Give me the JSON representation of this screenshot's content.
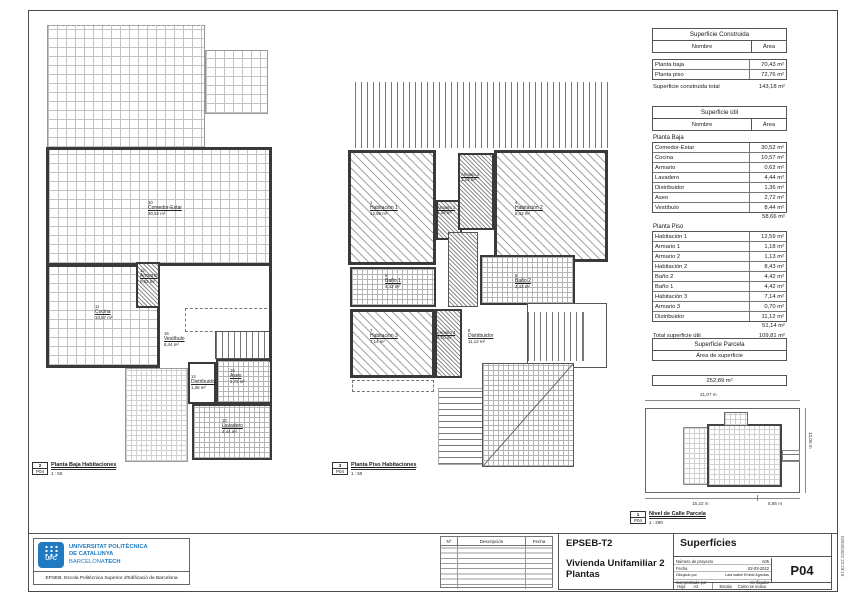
{
  "colors": {
    "brand_blue": "#1f7ac2",
    "wall_gray": "#3a3a3a"
  },
  "sheet": {
    "timestamp_vertical": "02/03/2022 22:29:19"
  },
  "surface_built": {
    "title": "Superficie Construida",
    "col_name": "Nombre",
    "col_area": "Área",
    "rows": [
      {
        "name": "Planta baja",
        "area": "70,43 m²"
      },
      {
        "name": "Planta piso",
        "area": "72,76 m²"
      }
    ],
    "total_label": "Superficie construida total",
    "total_value": "143,18 m²"
  },
  "surface_util": {
    "title": "Superficie útil",
    "col_name": "Nombre",
    "col_area": "Área",
    "baja_label": "Planta Baja",
    "baja_rows": [
      {
        "name": "Comedor-Estar",
        "area": "30,52 m²"
      },
      {
        "name": "Cocina",
        "area": "10,57 m²"
      },
      {
        "name": "Armario",
        "area": "0,62 m²"
      },
      {
        "name": "Lavadero",
        "area": "4,44 m²"
      },
      {
        "name": "Distribuidor",
        "area": "1,36 m²"
      },
      {
        "name": "Aseo",
        "area": "2,72 m²"
      },
      {
        "name": "Vestíbulo",
        "area": "8,44 m²"
      }
    ],
    "baja_subtotal": "58,66 m²",
    "piso_label": "Planta Piso",
    "piso_rows": [
      {
        "name": "Habitación 1",
        "area": "12,59 m²"
      },
      {
        "name": "Armario 1",
        "area": "1,18 m²"
      },
      {
        "name": "Armario 2",
        "area": "1,13 m²"
      },
      {
        "name": "Habitación 2",
        "area": "8,43 m²"
      },
      {
        "name": "Baño 2",
        "area": "4,42 m²"
      },
      {
        "name": "Baño 1",
        "area": "4,42 m²"
      },
      {
        "name": "Habitación 3",
        "area": "7,14 m²"
      },
      {
        "name": "Armario 3",
        "area": "0,70 m²"
      },
      {
        "name": "Distribuidor",
        "area": "11,12 m²"
      }
    ],
    "piso_subtotal": "51,14 m²",
    "total_label": "Total superficie útil",
    "total_value": "109,81 m²"
  },
  "surface_parcel": {
    "title": "Superficie Parcela",
    "subtitle": "Área de superficie",
    "value": "252,89 m²"
  },
  "plan_baja": {
    "rooms": [
      {
        "num": "10",
        "name": "Comedor-Estar",
        "area": "30,52 m²"
      },
      {
        "num": "11",
        "name": "Cocina",
        "area": "10,57 m²"
      },
      {
        "num": "12",
        "name": "Armario",
        "area": "0,62 m²"
      },
      {
        "num": "16",
        "name": "Vestíbulo",
        "area": "8,44 m²"
      },
      {
        "num": "14",
        "name": "Distribuidor",
        "area": "1,36 m²"
      },
      {
        "num": "15",
        "name": "Aseo",
        "area": "2,72 m²"
      },
      {
        "num": "13",
        "name": "Lavadero",
        "area": "4,44 m²"
      }
    ],
    "caption": {
      "num": "2",
      "title": "Planta Baja Habitaciones",
      "sheet": "P04",
      "scale": "1 : 50"
    }
  },
  "plan_piso": {
    "rooms": [
      {
        "num": "1",
        "name": "Habitación 1",
        "area": "12,59 m²"
      },
      {
        "num": "2",
        "name": "Armario 1",
        "area": "1,18 m²"
      },
      {
        "num": "3",
        "name": "Armario 2",
        "area": "1,13 m²"
      },
      {
        "num": "4",
        "name": "Habitación 2",
        "area": "8,43 m²"
      },
      {
        "num": "6",
        "name": "Baño 1",
        "area": "4,42 m²"
      },
      {
        "num": "5",
        "name": "Baño 2",
        "area": "4,42 m²"
      },
      {
        "num": "7",
        "name": "Habitación 3",
        "area": "7,14 m²"
      },
      {
        "num": "9",
        "name": "Armario 3",
        "area": "0,70 m²"
      },
      {
        "num": "8",
        "name": "Distribuidor",
        "area": "11,12 m²"
      }
    ],
    "caption": {
      "num": "3",
      "title": "Planta Piso Habitaciones",
      "sheet": "P04",
      "scale": "1 : 50"
    }
  },
  "site_plan": {
    "dims": {
      "top": "21,07 m",
      "right": "12,00 m",
      "bottom_left": "15,22 m",
      "bottom_right": "5,85 m"
    },
    "caption": {
      "num": "1",
      "title": "Nivel de Calle Parcela",
      "sheet": "P04",
      "scale": "1 : 200"
    }
  },
  "titleblock": {
    "project_code": "EPSEB-T2",
    "project_name_line1": "Vivienda Unifamiliar 2",
    "project_name_line2": "Plantas",
    "sheet_title": "Superfícies",
    "fields": [
      {
        "label": "Número de proyecto",
        "value": "A05"
      },
      {
        "label": "Fecha",
        "value": "02-03-2022"
      },
      {
        "label": "Dibujado por",
        "value": "Laia Isabel Embid Agredas"
      },
      {
        "label": "Comprobado por",
        "value": "Verificador"
      }
    ],
    "sheet_number": "P04",
    "hoja_label": "Hoja",
    "hoja_value": "A2",
    "escala_label": "Escala",
    "escala_value": "Como se indica",
    "revisions": {
      "col_num": "Nº",
      "col_desc": "Descripción",
      "col_fecha": "Fecha"
    }
  },
  "logo": {
    "upc_text": "UPC",
    "line1": "UNIVERSITAT POLITÈCNICA",
    "line2": "DE CATALUNYA",
    "line3_a": "BARCELONA",
    "line3_b": "TECH",
    "school": "EPSEB. Escola Politècnica Superior d'Edificació de Barcelona"
  }
}
